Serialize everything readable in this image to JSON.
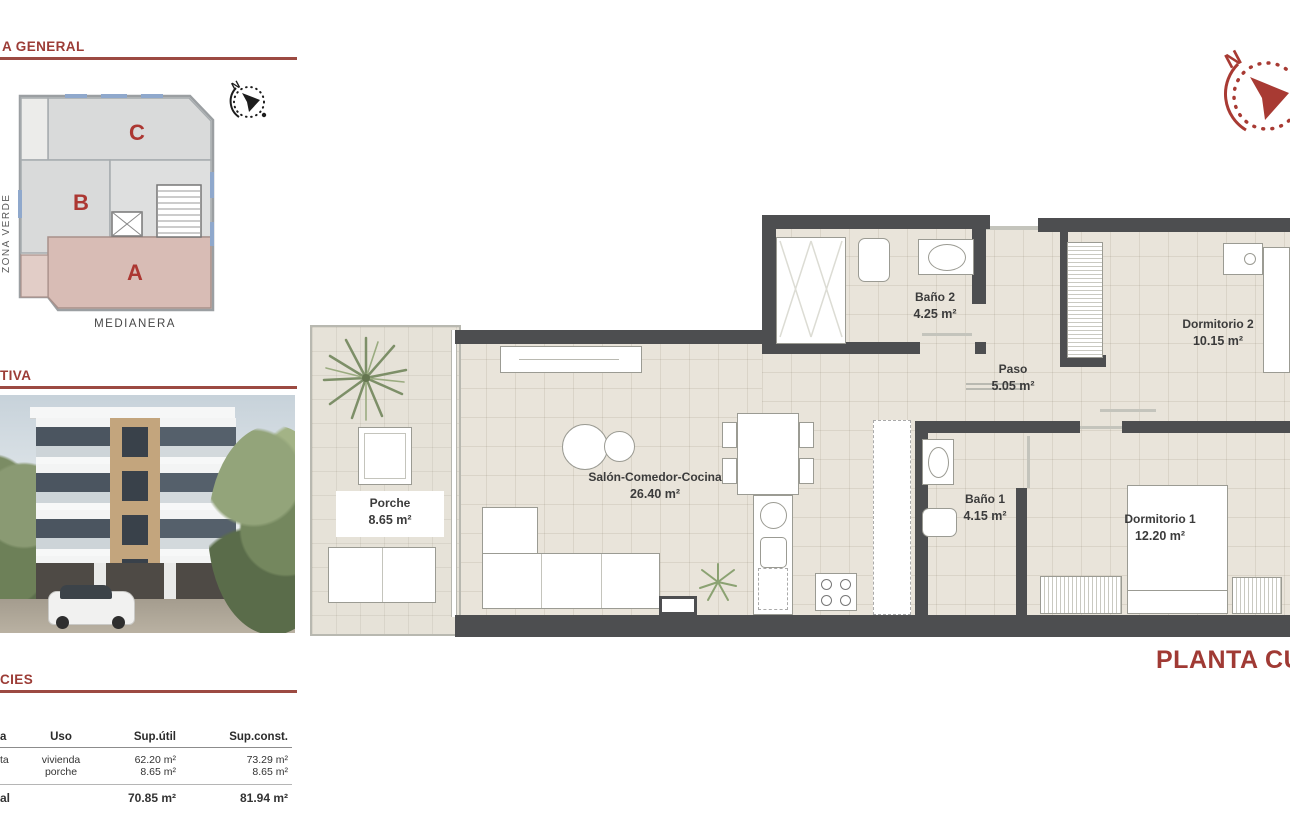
{
  "colors": {
    "accent": "#9c3c36",
    "wall": "#4d4e50",
    "floor": "#e9e4da",
    "zone_a_fill": "#d8bcb5",
    "zone_gray": "#d9dada"
  },
  "sections": {
    "general": {
      "title": "A GENERAL"
    },
    "perspective": {
      "title": "TIVA"
    },
    "surfaces": {
      "title": "CIES"
    }
  },
  "site_plan": {
    "zones": [
      {
        "label": "C"
      },
      {
        "label": "B"
      },
      {
        "label": "A"
      }
    ],
    "left_label": "ZONA VERDE",
    "bottom_label": "MEDIANERA",
    "compass_letter": "N"
  },
  "floor_plan": {
    "title": "PLANTA CUARTA",
    "compass_letter": "N",
    "rooms": [
      {
        "name": "Porche",
        "area": "8.65 m²"
      },
      {
        "name": "Salón-Comedor-Cocina",
        "area": "26.40 m²"
      },
      {
        "name": "Baño 2",
        "area": "4.25 m²"
      },
      {
        "name": "Paso",
        "area": "5.05 m²"
      },
      {
        "name": "Dormitorio 2",
        "area": "10.15 m²"
      },
      {
        "name": "Baño 1",
        "area": "4.15 m²"
      },
      {
        "name": "Dormitorio 1",
        "area": "12.20 m²"
      }
    ]
  },
  "surfaces_table": {
    "headers": {
      "planta": "a",
      "uso": "Uso",
      "sup_util": "Sup.útil",
      "sup_const": "Sup.const."
    },
    "rows": [
      {
        "planta": "ta",
        "uso": "vivienda",
        "sup_util": "62.20 m²",
        "sup_const": "73.29 m²"
      },
      {
        "planta": "",
        "uso": "porche",
        "sup_util": "8.65 m²",
        "sup_const": "8.65 m²"
      }
    ],
    "total": {
      "planta": "al",
      "uso": "",
      "sup_util": "70.85 m²",
      "sup_const": "81.94 m²"
    }
  }
}
